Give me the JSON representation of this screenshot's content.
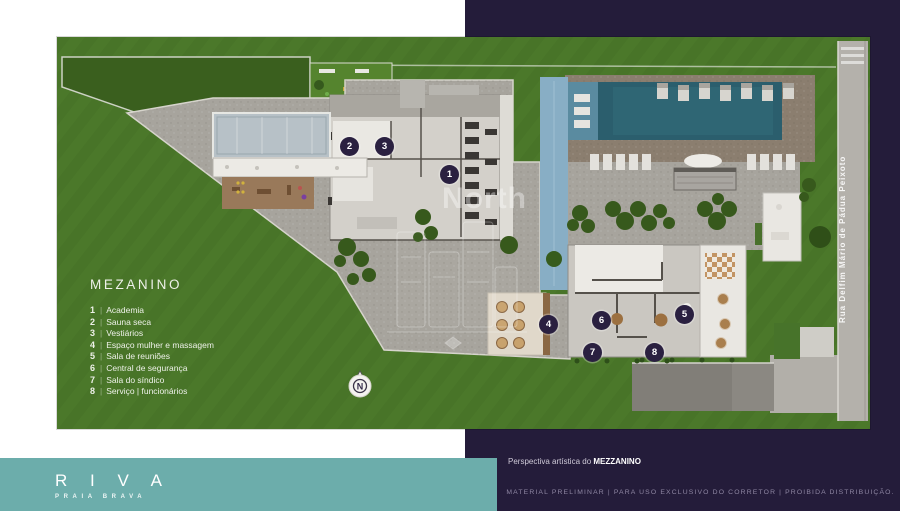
{
  "colors": {
    "navy": "#241c3a",
    "teal": "#6cadab",
    "grass": "#4b782a",
    "pool": "#2b5e6d",
    "marker": "#2a2040",
    "deck": "#8b7e6f"
  },
  "legend": {
    "title": "MEZANINO",
    "divider": "|",
    "items": [
      {
        "num": "1",
        "label": "Academia"
      },
      {
        "num": "2",
        "label": "Sauna seca"
      },
      {
        "num": "3",
        "label": "Vestiários"
      },
      {
        "num": "4",
        "label": "Espaço mulher e massagem"
      },
      {
        "num": "5",
        "label": "Sala de reuniões"
      },
      {
        "num": "6",
        "label": "Central de segurança"
      },
      {
        "num": "7",
        "label": "Sala do síndico"
      },
      {
        "num": "8",
        "label": "Serviço | funcionários"
      }
    ]
  },
  "plan": {
    "street_name": "Rua Delfim Mário de Pádua Peixoto",
    "watermark": "North",
    "compass_label": "N",
    "markers": [
      {
        "label": "1",
        "x": 392,
        "y": 137
      },
      {
        "label": "2",
        "x": 292,
        "y": 110
      },
      {
        "label": "3",
        "x": 327,
        "y": 110
      },
      {
        "label": "4",
        "x": 491,
        "y": 288
      },
      {
        "label": "5",
        "x": 628,
        "y": 278
      },
      {
        "label": "6",
        "x": 544,
        "y": 284
      },
      {
        "label": "7",
        "x": 536,
        "y": 316
      },
      {
        "label": "8",
        "x": 597,
        "y": 315
      }
    ]
  },
  "footer": {
    "logo_title": "R I V A",
    "logo_subtitle": "PRAIA BRAVA",
    "caption_prefix": "Perspectiva artística do ",
    "caption_bold": "MEZZANINO",
    "disclaimer": "MATERIAL PRELIMINAR | PARA USO EXCLUSIVO DO CORRETOR | PROIBIDA DISTRIBUIÇÃO."
  }
}
